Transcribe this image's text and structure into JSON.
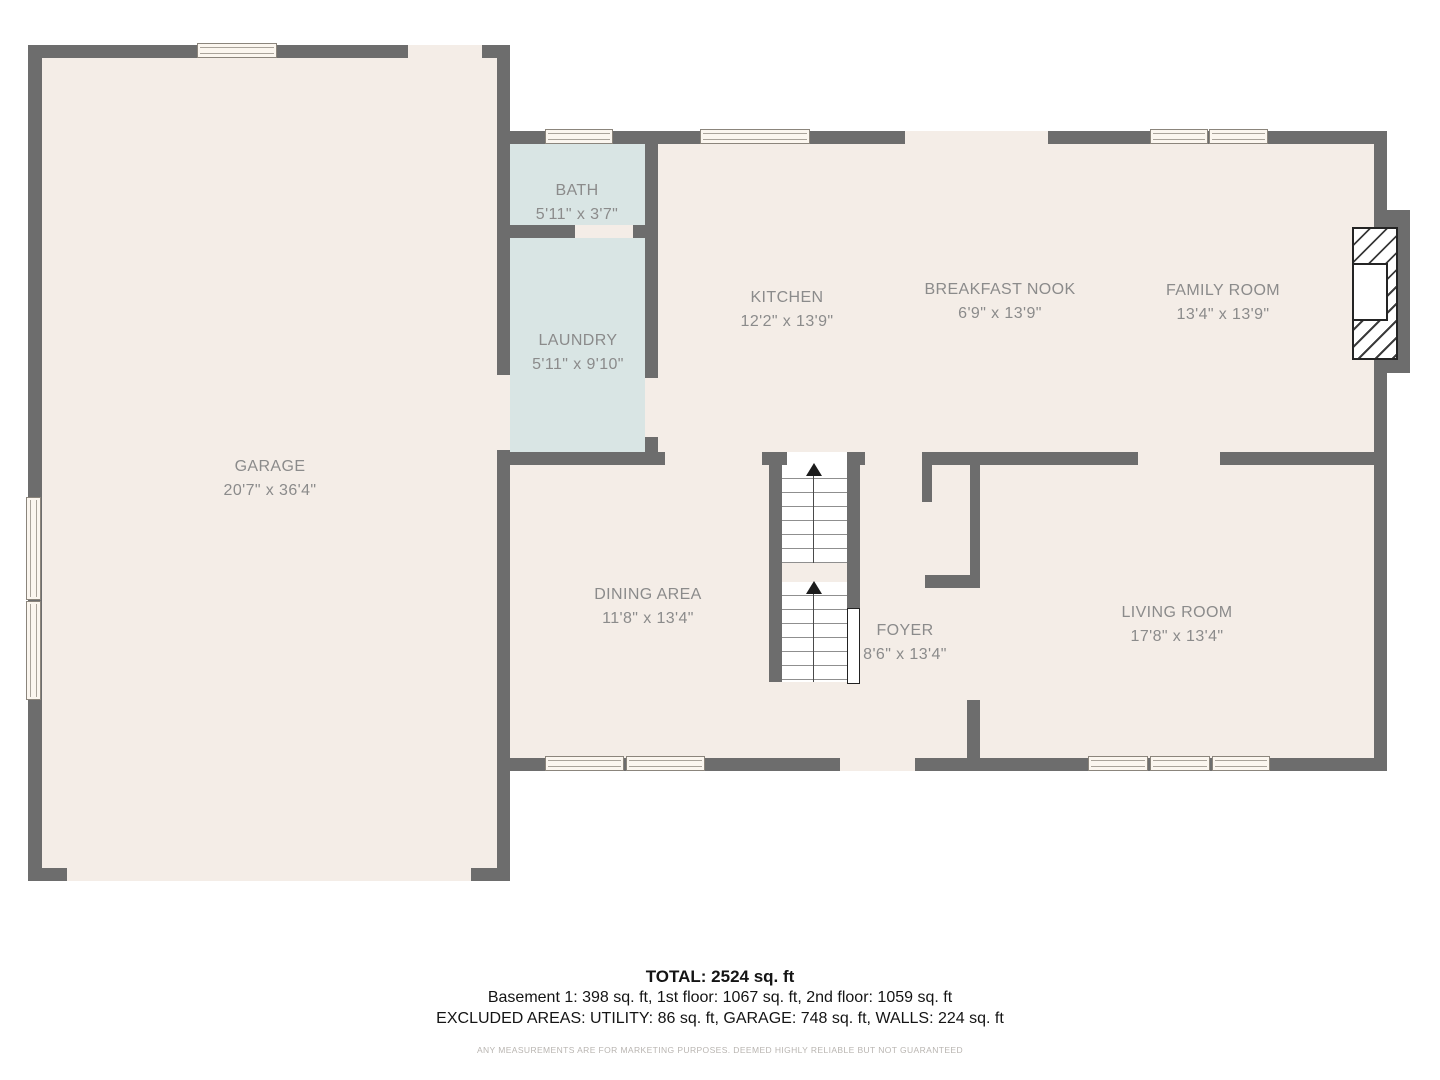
{
  "rooms": {
    "garage": {
      "name": "GARAGE",
      "dims": "20'7\" x 36'4\""
    },
    "bath": {
      "name": "BATH",
      "dims": "5'11\" x 3'7\""
    },
    "laundry": {
      "name": "LAUNDRY",
      "dims": "5'11\" x 9'10\""
    },
    "kitchen": {
      "name": "KITCHEN",
      "dims": "12'2\" x 13'9\""
    },
    "breakfast_nook": {
      "name": "BREAKFAST NOOK",
      "dims": "6'9\" x 13'9\""
    },
    "family_room": {
      "name": "FAMILY ROOM",
      "dims": "13'4\" x 13'9\""
    },
    "dining_area": {
      "name": "DINING AREA",
      "dims": "11'8\" x 13'4\""
    },
    "foyer": {
      "name": "FOYER",
      "dims": "8'6\" x 13'4\""
    },
    "living_room": {
      "name": "LIVING ROOM",
      "dims": "17'8\" x 13'4\""
    }
  },
  "summary": {
    "total": "TOTAL: 2524 sq. ft",
    "floors_line": "Basement 1: 398 sq. ft, 1st floor: 1067 sq. ft, 2nd floor: 1059 sq. ft",
    "excluded_line": "EXCLUDED AREAS: UTILITY: 86 sq. ft, GARAGE: 748 sq. ft, WALLS: 224 sq. ft",
    "disclaimer": "ANY MEASUREMENTS ARE FOR MARKETING PURPOSES. DEEMED HIGHLY RELIABLE BUT NOT GUARANTEED"
  },
  "colors": {
    "wall": "#6d6d6d",
    "floor": "#f4ede7",
    "wet_room": "#d9e5e4",
    "label": "#8b8b8b"
  }
}
